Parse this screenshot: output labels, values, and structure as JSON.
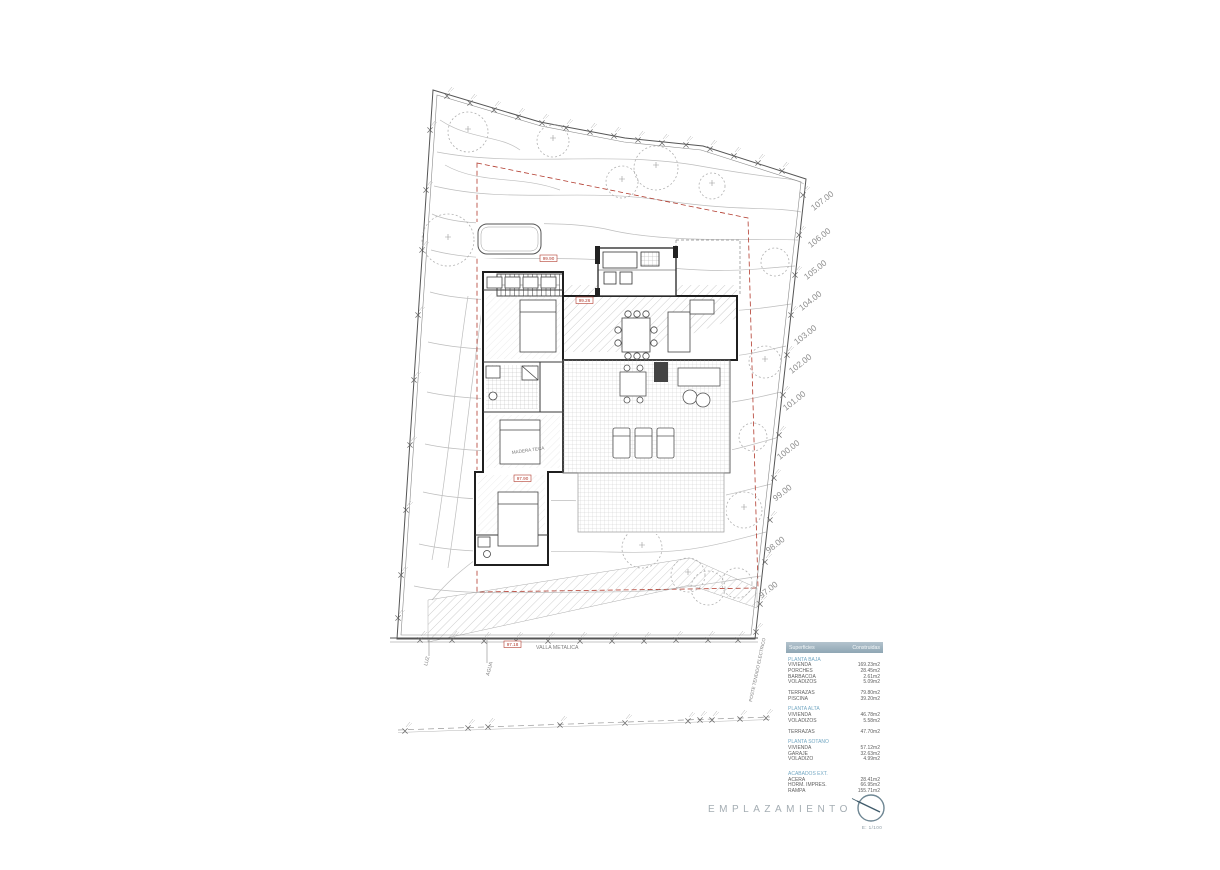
{
  "plan": {
    "contour_labels": [
      "107.00",
      "106.00",
      "105.00",
      "104.00",
      "103.00",
      "102.00",
      "101.00",
      "100.00",
      "99.00",
      "98.00",
      "97.00"
    ],
    "labels": {
      "fence": "VALLA METALICA",
      "luz": "LUZ",
      "agua": "AGUA",
      "poste": "POSTE TENDIDO ELECTRICO",
      "deck": "MADERA TECA"
    },
    "spot_levels": [
      "99.90",
      "99.26",
      "97.90",
      "97.18"
    ]
  },
  "titleblock": {
    "title": "EMPLAZAMIENTO",
    "scale": "E: 1/100",
    "north_icon": "compass-circle"
  },
  "table": {
    "header": {
      "col1": "Superficies",
      "col2": "Construidas"
    },
    "rows": [
      {
        "type": "section",
        "label": "PLANTA BAJA",
        "value": ""
      },
      {
        "type": "item",
        "label": "VIVIENDA",
        "value": "169.23m2"
      },
      {
        "type": "item",
        "label": "PORCHES",
        "value": "28.45m2"
      },
      {
        "type": "item",
        "label": "BARBACOA",
        "value": "2.61m2"
      },
      {
        "type": "item",
        "label": "VOLADIZOS",
        "value": "5.09m2"
      },
      {
        "type": "item",
        "label": "TERRAZAS",
        "value": "79.80m2"
      },
      {
        "type": "item",
        "label": "PISCINA",
        "value": "39.20m2"
      },
      {
        "type": "section",
        "label": "PLANTA ALTA",
        "value": ""
      },
      {
        "type": "item",
        "label": "VIVIENDA",
        "value": "46.78m2"
      },
      {
        "type": "item",
        "label": "VOLADIZOS",
        "value": "5.58m2"
      },
      {
        "type": "item",
        "label": "TERRAZAS",
        "value": "47.70m2"
      },
      {
        "type": "section",
        "label": "PLANTA SOTANO",
        "value": ""
      },
      {
        "type": "item",
        "label": "VIVIENDA",
        "value": "57.12m2"
      },
      {
        "type": "item",
        "label": "GARAJE",
        "value": "32.63m2"
      },
      {
        "type": "item",
        "label": "VOLADIZO",
        "value": "4.99m2"
      },
      {
        "type": "section",
        "label": "ACABADOS EXT.",
        "value": ""
      },
      {
        "type": "item",
        "label": "ACERA",
        "value": "28.41m2"
      },
      {
        "type": "item",
        "label": "HORM. IMPRES.",
        "value": "66.95m2"
      },
      {
        "type": "item",
        "label": "RAMPA",
        "value": "155.71m2"
      }
    ]
  },
  "colors": {
    "accent_red": "#b23b2e",
    "table_header_bg": "#8fa6b4",
    "section_blue": "#74a8c3",
    "line_dark": "#3c3c3c",
    "line_light": "#bdbdbd"
  }
}
